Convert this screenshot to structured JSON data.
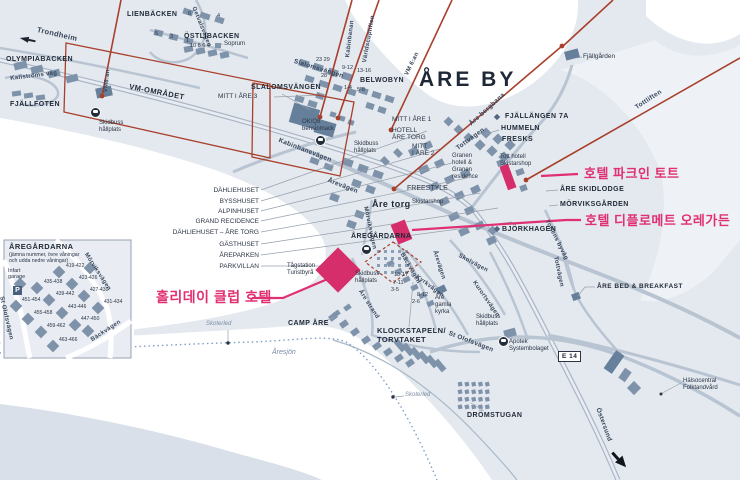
{
  "title": "ÅRE BY",
  "e14_badge": "E 14",
  "parking_label": "P",
  "colors": {
    "land": "#e4e9ef",
    "snow_water": "#ffffff",
    "deep_water": "#d9e0e9",
    "building": "#7e93aa",
    "building_dark": "#66809b",
    "road": "#b9c4d2",
    "lift_red": "#a8402c",
    "highlight_pink": "#e02f72",
    "label_text": "#1f2836",
    "trail_blue": "#7f9fc6"
  },
  "hotels": [
    {
      "id": "park-inn-tott",
      "label": "호텔 파크인 토트"
    },
    {
      "id": "diplomat-aregarden",
      "label": "호텔 디플로메트 오레가든"
    },
    {
      "id": "holiday-club",
      "label": "홀리데이 클럽 호텔"
    }
  ],
  "inset": {
    "title": "ÅREGÅRDARNA",
    "subtitle": "(jämna nummer, övre våningar\noch udda nedre våningar)",
    "units": [
      "419-422",
      "423-426",
      "427-430",
      "431-434",
      "435-438",
      "439-442",
      "443-446",
      "447-450",
      "451-454",
      "455-458",
      "459-462",
      "463-466"
    ],
    "streets": [
      "Mörviksvägen",
      "St Olofsvägen",
      "Bäckvägen"
    ]
  },
  "map_labels": [
    {
      "id": "trondheim",
      "cls": "s",
      "t": "Trondheim",
      "x": 38,
      "y": 26,
      "r": 13,
      "fs": 7.5
    },
    {
      "id": "olympiabacken",
      "cls": "b",
      "t": "OLYMPIABACKEN",
      "x": 6,
      "y": 56
    },
    {
      "id": "kallstroms-vag",
      "cls": "s",
      "t": "Kallströms väg",
      "x": 10,
      "y": 76,
      "r": -7,
      "fs": 6
    },
    {
      "id": "fjallfoten",
      "cls": "b",
      "t": "FJÄLLFOTEN",
      "x": 10,
      "y": 101
    },
    {
      "id": "vm-omradet",
      "cls": "b",
      "t": "VM-OMRÅDET",
      "x": 130,
      "y": 83,
      "r": 11,
      "fs": 7.5
    },
    {
      "id": "vm8an",
      "cls": "s",
      "t": "VM8:an",
      "x": 103,
      "y": 92,
      "r": -84,
      "fs": 6
    },
    {
      "id": "lienbacken",
      "cls": "b",
      "t": "LIENBÄCKEN",
      "x": 127,
      "y": 11
    },
    {
      "id": "lien-num-6",
      "cls": "n",
      "t": "6",
      "x": 188,
      "y": 11
    },
    {
      "id": "lien-num-4",
      "cls": "n",
      "t": "4",
      "x": 217,
      "y": 13
    },
    {
      "id": "lien-num-5",
      "cls": "n",
      "t": "5",
      "x": 155,
      "y": 31
    },
    {
      "id": "lien-num-3",
      "cls": "n",
      "t": "3",
      "x": 170,
      "y": 34
    },
    {
      "id": "lien-num-1",
      "cls": "n",
      "t": "1",
      "x": 186,
      "y": 38
    },
    {
      "id": "getvalsvagen",
      "cls": "s",
      "t": "Getvalsvägen",
      "x": 196,
      "y": 6,
      "r": 68,
      "fs": 6
    },
    {
      "id": "ostlibacken",
      "cls": "b",
      "t": "ÖSTLIBACKEN",
      "x": 184,
      "y": 33
    },
    {
      "id": "ostlibacken-nums",
      "cls": "n",
      "t": "10 8 6 4",
      "x": 190,
      "y": 43
    },
    {
      "id": "soprum",
      "cls": "p",
      "t": "Soprum",
      "x": 224,
      "y": 41,
      "fs": 6
    },
    {
      "id": "slalom-nums-23-29",
      "cls": "n",
      "t": "23  29",
      "x": 316,
      "y": 57
    },
    {
      "id": "slalom-num-28",
      "cls": "n",
      "t": "28",
      "x": 321,
      "y": 73
    },
    {
      "id": "slalomsvangen-street",
      "cls": "s",
      "t": "Slalomsvängen",
      "x": 295,
      "y": 58,
      "r": 17
    },
    {
      "id": "slalom-num-9-12",
      "cls": "n",
      "t": "9-12",
      "x": 342,
      "y": 65
    },
    {
      "id": "slalom-num-13-16",
      "cls": "n",
      "t": "13-16",
      "x": 357,
      "y": 68
    },
    {
      "id": "slalom-num-1-4",
      "cls": "n",
      "t": "1-4",
      "x": 344,
      "y": 85
    },
    {
      "id": "slalom-num-5-8",
      "cls": "n",
      "t": "5-8",
      "x": 357,
      "y": 87
    },
    {
      "id": "slalomsvangen-area",
      "cls": "b",
      "t": "SLALOMSVÄNGEN",
      "x": 251,
      "y": 84
    },
    {
      "id": "belwobyn",
      "cls": "b",
      "t": "BELWOBYN",
      "x": 360,
      "y": 77
    },
    {
      "id": "kabinbanan",
      "cls": "s",
      "t": "Kabinbanan",
      "x": 345,
      "y": 57,
      "r": -83,
      "fs": 6
    },
    {
      "id": "varldscupliften",
      "cls": "s",
      "t": "Världscupliften",
      "x": 362,
      "y": 62,
      "r": -80,
      "fs": 6
    },
    {
      "id": "vm6an",
      "cls": "s",
      "t": "VM 6:an",
      "x": 404,
      "y": 74,
      "r": -64,
      "fs": 6
    },
    {
      "id": "are-by",
      "cls": "b",
      "t": "ÅRE BY",
      "x": 419,
      "y": 68,
      "fs": 21
    },
    {
      "id": "okq8",
      "cls": "p",
      "t": "OK/Q8\nbensinmack",
      "x": 302,
      "y": 119,
      "fs": 6
    },
    {
      "id": "kabinbanevagen",
      "cls": "s",
      "t": "Kabinbanevägen",
      "x": 280,
      "y": 137,
      "r": 21
    },
    {
      "id": "skidbuss-1",
      "cls": "p",
      "t": "Skidbuss\nhållplats",
      "x": 99,
      "y": 120,
      "fs": 6
    },
    {
      "id": "skidbuss-2",
      "cls": "p",
      "t": "Skidbuss\nhållplats",
      "x": 354,
      "y": 141,
      "fs": 6
    },
    {
      "id": "mitt-i-are-1",
      "cls": "p",
      "t": "MITT I ÅRE 1",
      "x": 392,
      "y": 116
    },
    {
      "id": "hotell-are-torg",
      "cls": "p",
      "t": "HOTELL\nÅRE TORG",
      "x": 392,
      "y": 127
    },
    {
      "id": "mitt-i-are-2",
      "cls": "p",
      "t": "MITT\nI ÅRE 2",
      "x": 412,
      "y": 143
    },
    {
      "id": "mitt-i-are-3",
      "cls": "p",
      "t": "MITT I ÅRE 3",
      "x": 218,
      "y": 93
    },
    {
      "id": "fjallgarden",
      "cls": "p",
      "t": "Fjällgården",
      "x": 583,
      "y": 53
    },
    {
      "id": "tottliften",
      "cls": "s",
      "t": "Tottliften",
      "x": 634,
      "y": 105,
      "r": -33
    },
    {
      "id": "are-bergbana",
      "cls": "s",
      "t": "Åre bergbana",
      "x": 468,
      "y": 122,
      "r": -42
    },
    {
      "id": "fjallangen-7a",
      "cls": "b",
      "t": "FJÄLLÄNGEN 7A",
      "x": 505,
      "y": 113
    },
    {
      "id": "hummeln",
      "cls": "b",
      "t": "HUMMELN",
      "x": 501,
      "y": 125
    },
    {
      "id": "fresks",
      "cls": "b",
      "t": "FRESKS",
      "x": 502,
      "y": 136
    },
    {
      "id": "tottvagen-granen",
      "cls": "s",
      "t": "Tottvägen",
      "x": 455,
      "y": 146,
      "r": -36
    },
    {
      "id": "granen-hotell",
      "cls": "p",
      "t": "Granen\nhotell &\nGranen\nresidence",
      "x": 452,
      "y": 153,
      "fs": 6
    },
    {
      "id": "tott-hotell",
      "cls": "p",
      "t": "Tott hotell\nSkistarshop",
      "x": 500,
      "y": 154,
      "fs": 6
    },
    {
      "id": "arevagen-1",
      "cls": "s",
      "t": "Årevägen",
      "x": 329,
      "y": 177,
      "r": 21
    },
    {
      "id": "freestyle",
      "cls": "p",
      "t": "FREESTYLE",
      "x": 407,
      "y": 185,
      "fs": 7
    },
    {
      "id": "are-torg",
      "cls": "b",
      "t": "Åre torg",
      "x": 372,
      "y": 199,
      "fs": 9
    },
    {
      "id": "skistarshop",
      "cls": "p",
      "t": "Skistarshop",
      "x": 412,
      "y": 199,
      "fs": 6
    },
    {
      "id": "are-skidlodge",
      "cls": "b",
      "t": "ÅRE SKIDLODGE",
      "x": 560,
      "y": 186
    },
    {
      "id": "morviksgarden",
      "cls": "b",
      "t": "MÖRVIKSGÅRDEN",
      "x": 560,
      "y": 201
    },
    {
      "id": "morviksvagen-map",
      "cls": "s",
      "t": "Mörviksvägen",
      "x": 368,
      "y": 206,
      "r": 78,
      "fs": 6
    },
    {
      "id": "bjorkhagen",
      "cls": "b",
      "t": "BJÖRKHAGEN",
      "x": 502,
      "y": 226
    },
    {
      "id": "tottens-byvag",
      "cls": "s",
      "t": "Tottens byväg",
      "x": 549,
      "y": 219,
      "r": 63,
      "fs": 6
    },
    {
      "id": "tottvagen-right",
      "cls": "s",
      "t": "Tottvägen",
      "x": 558,
      "y": 256,
      "r": 78,
      "fs": 6
    },
    {
      "id": "dahliehuset",
      "cls": "p",
      "t": "DÄHLIEHUSET",
      "x": 259,
      "y": 187,
      "al": "r"
    },
    {
      "id": "bysshuset",
      "cls": "p",
      "t": "BYSSHUSET",
      "x": 259,
      "y": 198,
      "al": "r"
    },
    {
      "id": "alpinhuset",
      "cls": "p",
      "t": "ALPINHUSET",
      "x": 259,
      "y": 208,
      "al": "r"
    },
    {
      "id": "grand-recidence",
      "cls": "p",
      "t": "GRAND RECIDENCE",
      "x": 259,
      "y": 218,
      "al": "r"
    },
    {
      "id": "dahliehuset-are-torg",
      "cls": "p",
      "t": "DÄHLIEHUSET – ÅRE TORG",
      "x": 259,
      "y": 229,
      "al": "r"
    },
    {
      "id": "gasthuset",
      "cls": "p",
      "t": "GÄSTHUSET",
      "x": 259,
      "y": 241,
      "al": "r"
    },
    {
      "id": "areparken",
      "cls": "p",
      "t": "ÅREPARKEN",
      "x": 259,
      "y": 252,
      "al": "r"
    },
    {
      "id": "parkvillan",
      "cls": "p",
      "t": "PARKVILLAN",
      "x": 259,
      "y": 263,
      "al": "r"
    },
    {
      "id": "aregardarna-map",
      "cls": "b",
      "t": "ÅREGÅRDARNA",
      "x": 351,
      "y": 233
    },
    {
      "id": "tagstation",
      "cls": "p",
      "t": "Tågstation\nTuristbyrå",
      "x": 287,
      "y": 263,
      "fs": 6
    },
    {
      "id": "skidbuss-3",
      "cls": "p",
      "t": "Skidbuss\nhållplats",
      "x": 355,
      "y": 271,
      "fs": 6
    },
    {
      "id": "backvagen-map",
      "cls": "s",
      "t": "Bäckvägen",
      "x": 404,
      "y": 252,
      "r": 60,
      "fs": 6
    },
    {
      "id": "arevagen-2",
      "cls": "s",
      "t": "Årevägen",
      "x": 437,
      "y": 250,
      "r": 72,
      "fs": 6
    },
    {
      "id": "skolvagen",
      "cls": "s",
      "t": "Skolvägen",
      "x": 460,
      "y": 253,
      "r": 28,
      "fs": 6
    },
    {
      "id": "kyrkvagen",
      "cls": "s",
      "t": "Kyrkvägen",
      "x": 418,
      "y": 274,
      "r": 37,
      "fs": 6
    },
    {
      "id": "kurortsvagen",
      "cls": "s",
      "t": "Kurortsvägen",
      "x": 476,
      "y": 280,
      "r": 55,
      "fs": 6
    },
    {
      "id": "num-13-17",
      "cls": "n",
      "t": "13-17",
      "x": 394,
      "y": 272
    },
    {
      "id": "num-7-11",
      "cls": "n",
      "t": "7-11",
      "x": 393,
      "y": 280
    },
    {
      "id": "num-3-5",
      "cls": "n",
      "t": "3-5",
      "x": 391,
      "y": 287
    },
    {
      "id": "num-8-12",
      "cls": "n",
      "t": "8-12",
      "x": 417,
      "y": 292
    },
    {
      "id": "num-2-6",
      "cls": "n",
      "t": "2-6",
      "x": 412,
      "y": 299
    },
    {
      "id": "are-gamla-kyrka",
      "cls": "p",
      "t": "Åre\ngamla\nkyrka",
      "x": 435,
      "y": 295,
      "fs": 6
    },
    {
      "id": "are-bed-breakfast",
      "cls": "b",
      "t": "ÅRE BED & BREAKFAST",
      "x": 597,
      "y": 283,
      "fs": 6.5
    },
    {
      "id": "are-strand",
      "cls": "s",
      "t": "Åre strand",
      "x": 362,
      "y": 289,
      "r": 57,
      "fs": 6
    },
    {
      "id": "camp-are",
      "cls": "b",
      "t": "CAMP ÅRE",
      "x": 288,
      "y": 320
    },
    {
      "id": "skoterled-1",
      "cls": "i",
      "t": "Skoterled",
      "x": 206,
      "y": 321,
      "fs": 6
    },
    {
      "id": "skoterled-2",
      "cls": "i",
      "t": "Skoterled",
      "x": 405,
      "y": 392,
      "fs": 6
    },
    {
      "id": "aresjon",
      "cls": "i",
      "t": "Åresjön",
      "x": 272,
      "y": 349,
      "fs": 7
    },
    {
      "id": "klockstapeln",
      "cls": "b",
      "t": "KLOCKSTAPELN/\nTORVTAKET",
      "x": 377,
      "y": 327,
      "fs": 7.5
    },
    {
      "id": "st-olofsvagen-map",
      "cls": "s",
      "t": "St Olofsvägen",
      "x": 450,
      "y": 330,
      "r": 21
    },
    {
      "id": "skidbuss-4",
      "cls": "p",
      "t": "Skidbuss\nhållplats",
      "x": 476,
      "y": 314,
      "fs": 6
    },
    {
      "id": "apotek",
      "cls": "p",
      "t": "Apotek\nSystembolaget",
      "x": 509,
      "y": 339,
      "fs": 6
    },
    {
      "id": "dromstugan",
      "cls": "b",
      "t": "DRÖMSTUGAN",
      "x": 467,
      "y": 412
    },
    {
      "id": "ostersund",
      "cls": "s",
      "t": "Östersund",
      "x": 601,
      "y": 407,
      "r": 70
    },
    {
      "id": "halsocentral",
      "cls": "p",
      "t": "Hälsocentral\nFolktandvård",
      "x": 683,
      "y": 378,
      "fs": 6
    },
    {
      "id": "inset-title",
      "cls": "b",
      "t": "ÅREGÅRDARNA",
      "x": 9,
      "y": 243,
      "fs": 7.5
    },
    {
      "id": "inset-subtitle",
      "cls": "p",
      "t": "(jämna nummer, övre våningar\noch udda nedre våningar)",
      "x": 9,
      "y": 253,
      "fs": 5.2
    },
    {
      "id": "inset-infart-garage",
      "cls": "p",
      "t": "Infart\ngarage",
      "x": 8,
      "y": 268,
      "fs": 5.5
    },
    {
      "id": "inset-morviksvagen",
      "cls": "s",
      "t": "Mörviksvägen",
      "x": 88,
      "y": 252,
      "r": 57,
      "fs": 6
    },
    {
      "id": "inset-st-olofsvagen",
      "cls": "s",
      "t": "St Olofsvägen",
      "x": 4,
      "y": 296,
      "r": 77,
      "fs": 6
    },
    {
      "id": "inset-backvagen",
      "cls": "s",
      "t": "Bäckvägen",
      "x": 90,
      "y": 338,
      "r": -33,
      "fs": 6
    },
    {
      "id": "inset-unit-419-422",
      "cls": "n",
      "t": "419-422",
      "x": 66,
      "y": 264,
      "fs": 5
    },
    {
      "id": "inset-unit-423-426",
      "cls": "n",
      "t": "423-426",
      "x": 79,
      "y": 276,
      "fs": 5
    },
    {
      "id": "inset-unit-427-430",
      "cls": "n",
      "t": "427-430",
      "x": 90,
      "y": 288,
      "fs": 5
    },
    {
      "id": "inset-unit-431-434",
      "cls": "n",
      "t": "431-434",
      "x": 104,
      "y": 300,
      "fs": 5
    },
    {
      "id": "inset-unit-435-438",
      "cls": "n",
      "t": "435-438",
      "x": 44,
      "y": 280,
      "fs": 5
    },
    {
      "id": "inset-unit-439-442",
      "cls": "n",
      "t": "439-442",
      "x": 56,
      "y": 292,
      "fs": 5
    },
    {
      "id": "inset-unit-443-446",
      "cls": "n",
      "t": "443-446",
      "x": 68,
      "y": 305,
      "fs": 5
    },
    {
      "id": "inset-unit-447-450",
      "cls": "n",
      "t": "447-450",
      "x": 81,
      "y": 317,
      "fs": 5
    },
    {
      "id": "inset-unit-451-454",
      "cls": "n",
      "t": "451-454",
      "x": 22,
      "y": 298,
      "fs": 5
    },
    {
      "id": "inset-unit-455-458",
      "cls": "n",
      "t": "455-458",
      "x": 34,
      "y": 311,
      "fs": 5
    },
    {
      "id": "inset-unit-459-462",
      "cls": "n",
      "t": "459-462",
      "x": 47,
      "y": 324,
      "fs": 5
    },
    {
      "id": "inset-unit-463-466",
      "cls": "n",
      "t": "463-466",
      "x": 59,
      "y": 338,
      "fs": 5
    }
  ]
}
